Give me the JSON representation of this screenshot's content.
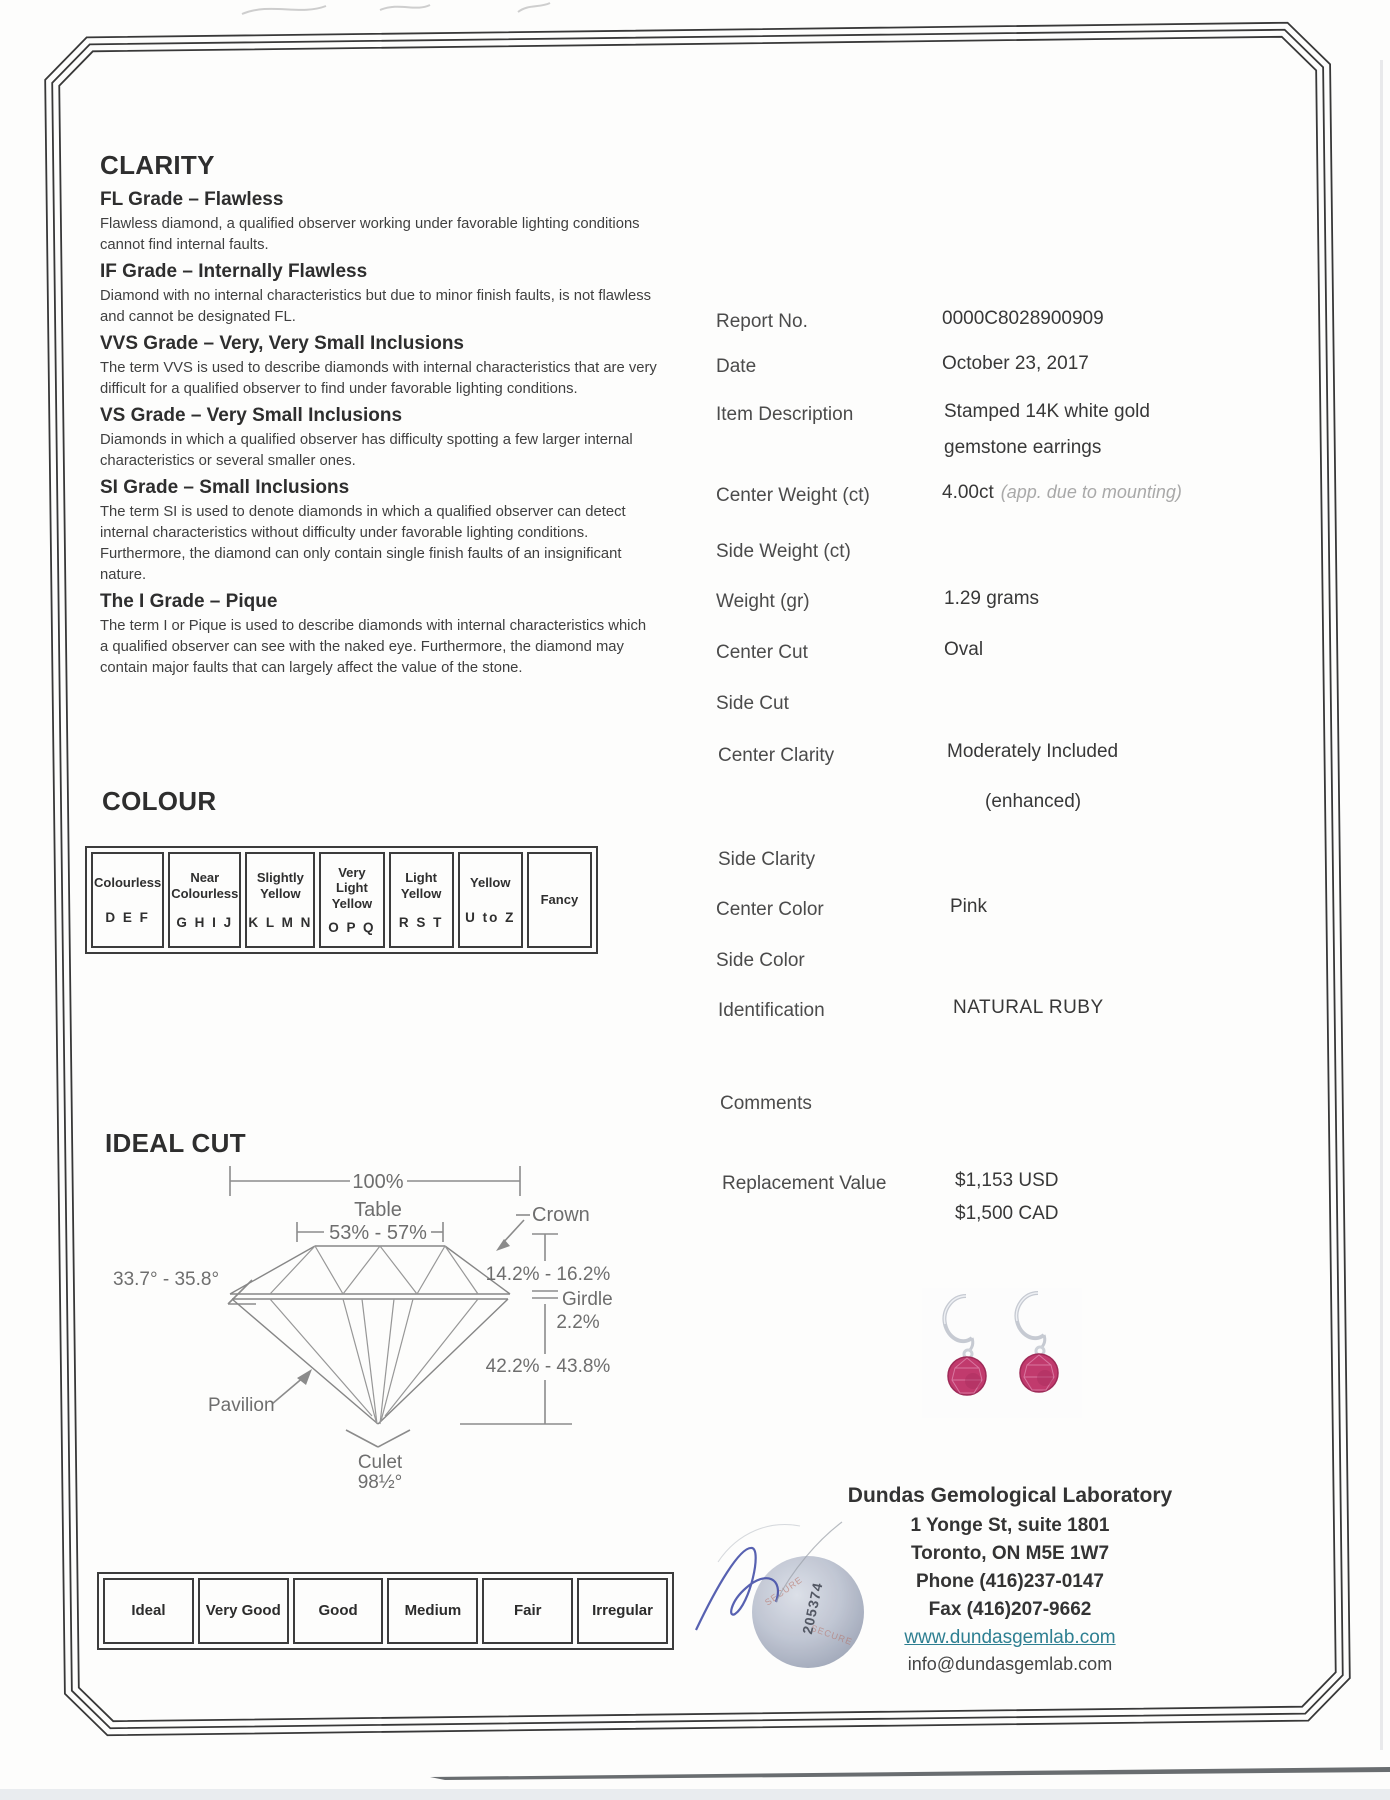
{
  "clarity": {
    "title": "CLARITY",
    "grades": [
      {
        "heading": "FL Grade – Flawless",
        "body": "Flawless diamond, a qualified observer working under favorable lighting conditions cannot find internal faults."
      },
      {
        "heading": "IF Grade – Internally Flawless",
        "body": "Diamond with no internal characteristics but due to minor finish faults, is not flawless and cannot be designated FL."
      },
      {
        "heading": "VVS Grade – Very, Very Small Inclusions",
        "body": "The term VVS is used to describe diamonds with internal characteristics that are very difficult for a qualified observer to find under favorable lighting conditions."
      },
      {
        "heading": "VS Grade – Very Small Inclusions",
        "body": "Diamonds in which a qualified observer has difficulty spotting a few larger internal characteristics or several smaller ones."
      },
      {
        "heading": "SI Grade – Small Inclusions",
        "body": "The term SI is used to denote diamonds in which a qualified observer can detect internal characteristics without difficulty under favorable lighting conditions. Furthermore, the diamond can only contain single finish faults of an insignificant nature."
      },
      {
        "heading": "The I Grade – Pique",
        "body": "The term I or Pique is used to describe diamonds with internal characteristics which a qualified observer can see with the naked eye. Furthermore, the diamond may contain major faults that can largely affect the value of the stone."
      }
    ]
  },
  "report": {
    "report_no": {
      "label": "Report No.",
      "value": "0000C8028900909"
    },
    "date": {
      "label": "Date",
      "value": "October 23, 2017"
    },
    "item_description": {
      "label": "Item Description",
      "value_line1": "Stamped 14K white gold",
      "value_line2": "gemstone earrings"
    },
    "center_weight": {
      "label": "Center Weight (ct)",
      "value": "4.00ct",
      "note": "(app. due to mounting)"
    },
    "side_weight": {
      "label": "Side Weight (ct)",
      "value": ""
    },
    "weight_gr": {
      "label": "Weight (gr)",
      "value": "1.29 grams"
    },
    "center_cut": {
      "label": "Center Cut",
      "value": "Oval"
    },
    "side_cut": {
      "label": "Side Cut",
      "value": ""
    },
    "center_clarity": {
      "label": "Center Clarity",
      "value": "Moderately Included",
      "value_note": "(enhanced)"
    },
    "side_clarity": {
      "label": "Side Clarity",
      "value": ""
    },
    "center_color": {
      "label": "Center Color",
      "value": "Pink"
    },
    "side_color": {
      "label": "Side Color",
      "value": ""
    },
    "identification": {
      "label": "Identification",
      "value": "NATURAL RUBY"
    },
    "comments": {
      "label": "Comments",
      "value": ""
    },
    "replacement_value": {
      "label": "Replacement Value",
      "value_usd": "$1,153 USD",
      "value_cad": "$1,500 CAD"
    }
  },
  "colour": {
    "title": "COLOUR",
    "cells": [
      {
        "label": "Colourless",
        "letters": "D E F"
      },
      {
        "label": "Near Colourless",
        "letters": "G H I J"
      },
      {
        "label": "Slightly Yellow",
        "letters": "K L M N"
      },
      {
        "label": "Very Light Yellow",
        "letters": "O P Q"
      },
      {
        "label": "Light Yellow",
        "letters": "R S T"
      },
      {
        "label": "Yellow",
        "letters": "U to Z"
      },
      {
        "label": "Fancy",
        "letters": ""
      }
    ]
  },
  "ideal_cut": {
    "title": "IDEAL CUT",
    "labels": {
      "diameter_pct": "100%",
      "table": "Table",
      "table_pct": "53% - 57%",
      "crown": "Crown",
      "crown_pct": "14.2% - 16.2%",
      "crown_angle": "33.7° - 35.8°",
      "girdle": "Girdle",
      "girdle_pct": "2.2%",
      "pavilion_pct": "42.2% - 43.8%",
      "pavilion": "Pavilion",
      "culet": "Culet",
      "culet_angle": "98½°"
    }
  },
  "cut_scale": {
    "cells": [
      "Ideal",
      "Very Good",
      "Good",
      "Medium",
      "Fair",
      "Irregular"
    ]
  },
  "lab": {
    "name": "Dundas Gemological Laboratory",
    "address_line1": "1 Yonge St, suite 1801",
    "address_line2": "Toronto, ON M5E 1W7",
    "phone": "Phone (416)237-0147",
    "fax": "Fax (416)207-9662",
    "website": "www.dundasgemlab.com",
    "email": "info@dundasgemlab.com",
    "stamp_number": "205374",
    "stamp_word": "SECURE"
  },
  "colors": {
    "link_teal": "#2e7f91",
    "gem_pink": "#c13a6d",
    "signature_ink": "#4550a8"
  }
}
